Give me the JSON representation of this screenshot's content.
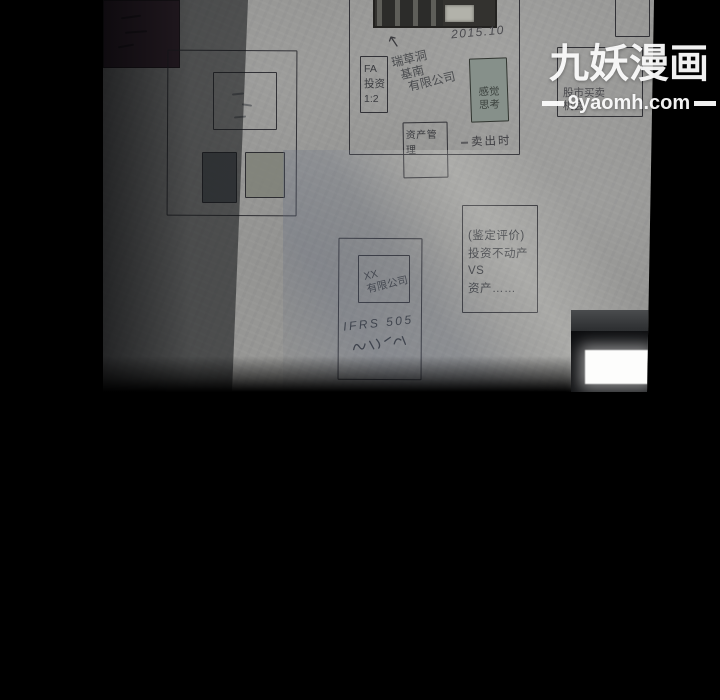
{
  "watermark": {
    "site_name": "九妖漫画",
    "site_url": "9yaomh.com"
  },
  "board": {
    "photo_date": "2015.10",
    "fa_box": {
      "lines": [
        "FA",
        "投资",
        "1:2"
      ]
    },
    "company_note": {
      "lines": [
        "瑞草洞",
        "基南",
        "有限公司"
      ]
    },
    "feeling_box": {
      "lines": [
        "感觉",
        "思考"
      ]
    },
    "asset_box": {
      "label": "资产管理"
    },
    "sell_note": "卖出时",
    "stock_box": {
      "lines": [
        "股市买卖",
        "机会"
      ]
    },
    "xx_box": {
      "lines": [
        "XX",
        "有限公司"
      ]
    },
    "handwritten_note": "IFRS 505",
    "appraisal_box": {
      "lines": [
        "(鉴定评价)",
        "投资不动产",
        "VS",
        "资产……"
      ]
    }
  },
  "colors": {
    "background": "#000000",
    "wall": "#969694",
    "maroon_patch": "#35202c",
    "feeling_box_fill": "#86908a",
    "board_ink": "#35373c",
    "window_glow": "#fdfdfc",
    "watermark": "#fdfdfd"
  }
}
